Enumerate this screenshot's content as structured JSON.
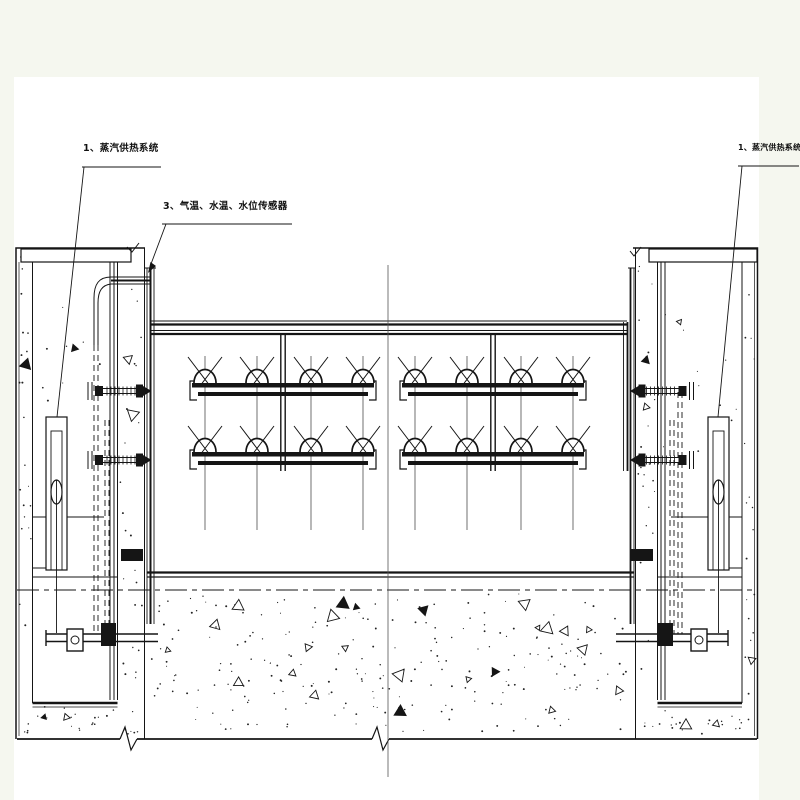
{
  "page": {
    "background": "#f5f7ef",
    "paper": "#ffffff",
    "ink": "#151515",
    "centerline_color": "#555555"
  },
  "annotations": {
    "label_left": "1、蒸汽供热系统",
    "label_mid": "3、气温、水温、水位传感器",
    "label_right": "1、蒸汽供热系统"
  },
  "drawing": {
    "type": "gate-steam-heating-elevation",
    "nozzles": {
      "rows_y": [
        383,
        452
      ],
      "groups": [
        {
          "x1": 192,
          "x2": 374,
          "centers": [
            205,
            257,
            311,
            363
          ],
          "feed_x": 283
        },
        {
          "x1": 402,
          "x2": 584,
          "centers": [
            415,
            467,
            521,
            573
          ],
          "feed_x": 493
        }
      ],
      "stem_top": 356,
      "stem_bottom": 530,
      "feed_top": 334,
      "feed_bottom": 471
    },
    "fittings": {
      "cys": [
        391,
        460
      ]
    }
  }
}
